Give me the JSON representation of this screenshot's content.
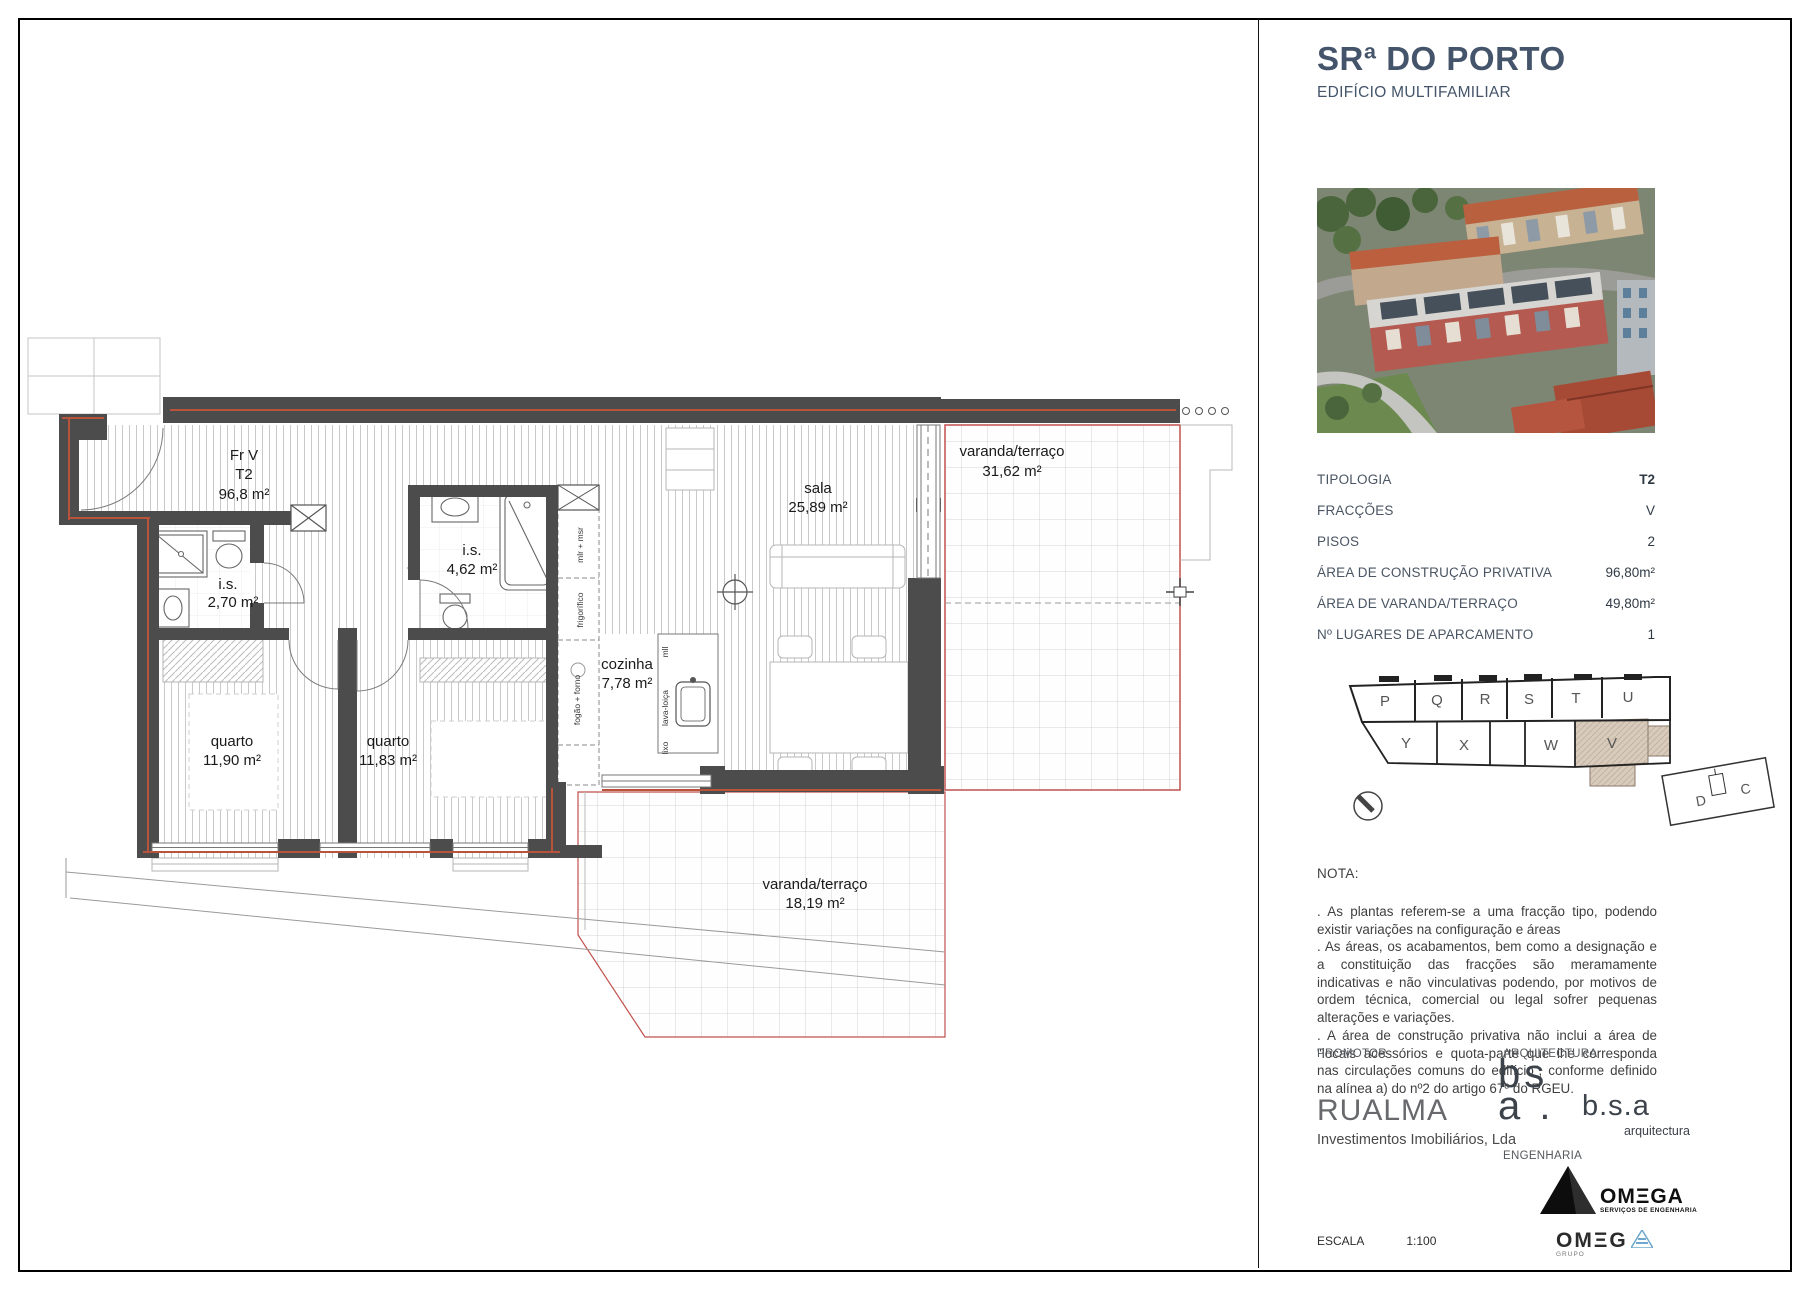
{
  "colors": {
    "title_accent": "#44546A",
    "wall": "#4C4C4C",
    "wall_core_line": "#B9543C",
    "fraction_boundary": "#C0504D",
    "highlighted_unit_fill": "#D9CBBC"
  },
  "header": {
    "title": "SRª DO PORTO",
    "subtitle": "EDIFÍCIO MULTIFAMILIAR"
  },
  "specs": {
    "rows": [
      {
        "label": "TIPOLOGIA",
        "value": "T2"
      },
      {
        "label": "FRACÇÕES",
        "value": "V"
      },
      {
        "label": "PISOS",
        "value": "2"
      },
      {
        "label": "ÁREA DE CONSTRUÇÃO PRIVATIVA",
        "value": "96,80m²"
      },
      {
        "label": "ÁREA DE VARANDA/TERRAÇO",
        "value": "49,80m²"
      },
      {
        "label": "Nº LUGARES DE APARCAMENTO",
        "value": "1"
      }
    ]
  },
  "key_plan": {
    "top_units": [
      "P",
      "Q",
      "R",
      "S",
      "T",
      "U"
    ],
    "bottom_units": [
      "Y",
      "X",
      "W",
      "V"
    ],
    "annex_units": [
      "D",
      "C"
    ],
    "highlighted_unit": "V"
  },
  "nota": {
    "heading": "NOTA:",
    "paragraphs": [
      ". As plantas referem-se a uma fracção tipo, podendo existir variações na configuração e áreas",
      ". As áreas, os acabamentos, bem como a designação e a constituição das fracções são meramamente indicativas e não vinculativas podendo, por motivos de ordem técnica, comercial ou legal sofrer pequenas alterações e variações.",
      ". A área de construção privativa não inclui a área de \"locais acessórios e quota-parte que lhe corresponda nas circulações comuns do edifício\", conforme definido na alínea a) do nº2 do artigo 67º do RGEU."
    ]
  },
  "credits": {
    "promotor_label": "PROMOTOR",
    "arquitectura_label": "ARQUITECTURA",
    "engenharia_label": "ENGENHARIA",
    "promotor_name": "RUALMA",
    "promotor_subtitle": "Investimentos Imobiliários, Lda",
    "bsa_mark_line1": "bs",
    "bsa_mark_line2": "a .",
    "bsa_name": "b.s.a",
    "bsa_tagline": "arquitectura",
    "omega_name": "OMΞGA",
    "omega_tagline": "SERVIÇOS DE ENGENHARIA",
    "omega_grupo_name": "OMΞG",
    "omega_grupo_label": "GRUPO"
  },
  "scale_block": {
    "label": "ESCALA",
    "value": "1:100"
  },
  "plan": {
    "unit": {
      "line1": "Fr V",
      "line2": "T2",
      "line3": "96,8 m²"
    },
    "rooms": [
      {
        "name": "i.s.",
        "area": "2,70 m²"
      },
      {
        "name": "i.s.",
        "area": "4,62 m²"
      },
      {
        "name": "quarto",
        "area": "11,90 m²"
      },
      {
        "name": "quarto",
        "area": "11,83 m²"
      },
      {
        "name": "cozinha",
        "area": "7,78 m²"
      },
      {
        "name": "sala",
        "area": "25,89 m²"
      },
      {
        "name": "varanda/terraço",
        "area": "31,62 m²"
      },
      {
        "name": "varanda/terraço",
        "area": "18,19 m²"
      }
    ],
    "kitchen_labels": [
      "mlr + msr",
      "frigorífico",
      "fogão + forno",
      "mll",
      "lava-loiça",
      "lixo"
    ]
  }
}
